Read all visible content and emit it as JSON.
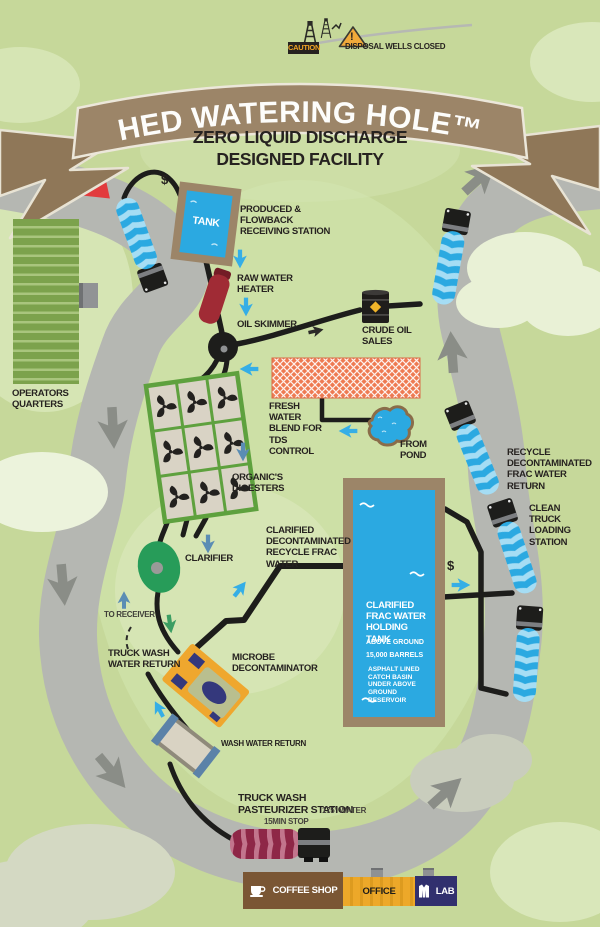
{
  "header": {
    "caution_sign": "CAUTION",
    "exclamation": "!",
    "warning_text": "DISPOSAL WELLS CLOSED",
    "title": "HED WATERING HOLE™",
    "subtitle_line1": "ZERO LIQUID DISCHARGE",
    "subtitle_line2": "DESIGNED FACILITY"
  },
  "flow": {
    "receiving_station": "PRODUCED & FLOWBACK RECEIVING STATION",
    "tank": "TANK",
    "truck_fee": "$",
    "loading_fee": "$",
    "raw_water_heater": "RAW WATER HEATER",
    "oil_skimmer": "OIL  SKIMMER",
    "crude_oil_sales": "CRUDE OIL SALES",
    "fresh_water_blend": "FRESH WATER BLEND FOR TDS CONTROL",
    "from_pond": "FROM POND",
    "organics_digesters": "ORGANIC'S DIGESTERS",
    "clarifier": "CLARIFIER",
    "clarified_water": "CLARIFIED DECONTAMINATED RECYCLE FRAC WATER",
    "to_receiver": "TO RECEIVER",
    "truck_wash_water_return": "TRUCK WASH WATER RETURN",
    "microbe_decontaminator": "MICROBE DECONTAMINATOR",
    "wash_water_return": "WASH WATER RETURN",
    "pasteurizer_line1": "TRUCK WASH",
    "pasteurizer_line2": "PASTEURIZER STATION",
    "pasteurizer_temp": "175° WATER",
    "pasteurizer_stop": "15MIN STOP",
    "recycle_return": "RECYCLE DECONTAMINATED FRAC WATER RETURN",
    "clean_truck_loading": "CLEAN TRUCK LOADING STATION"
  },
  "holding_tank": {
    "title": "CLARIFIED FRAC WATER HOLDING TANK",
    "line1": "ABOVE GROUND",
    "line2": "15,000 BARRELS",
    "line3": "ASPHALT LINED CATCH BASIN UNDER ABOVE GROUND RESERVOIR"
  },
  "site": {
    "operators_quarters": "OPERATORS QUARTERS",
    "coffee_shop": "COFFEE SHOP",
    "office": "OFFICE",
    "lab": "LAB"
  },
  "colors": {
    "background": "#c6d89a",
    "road": "#b5b7b2",
    "banner_brown": "#9c8568",
    "water_blue": "#2ba9e1",
    "pipe_black": "#1d1d1b",
    "arrow_red": "#e23b3d",
    "arrow_blue": "#35aee6",
    "truck_blue": "#29a8e0",
    "pasteurizer_maroon": "#8e2747",
    "digester_green": "#5ea13e",
    "clarifier_green": "#279c59",
    "office_orange": "#eda829",
    "lab_navy": "#31306e",
    "coffee_brown": "#7a5634"
  }
}
